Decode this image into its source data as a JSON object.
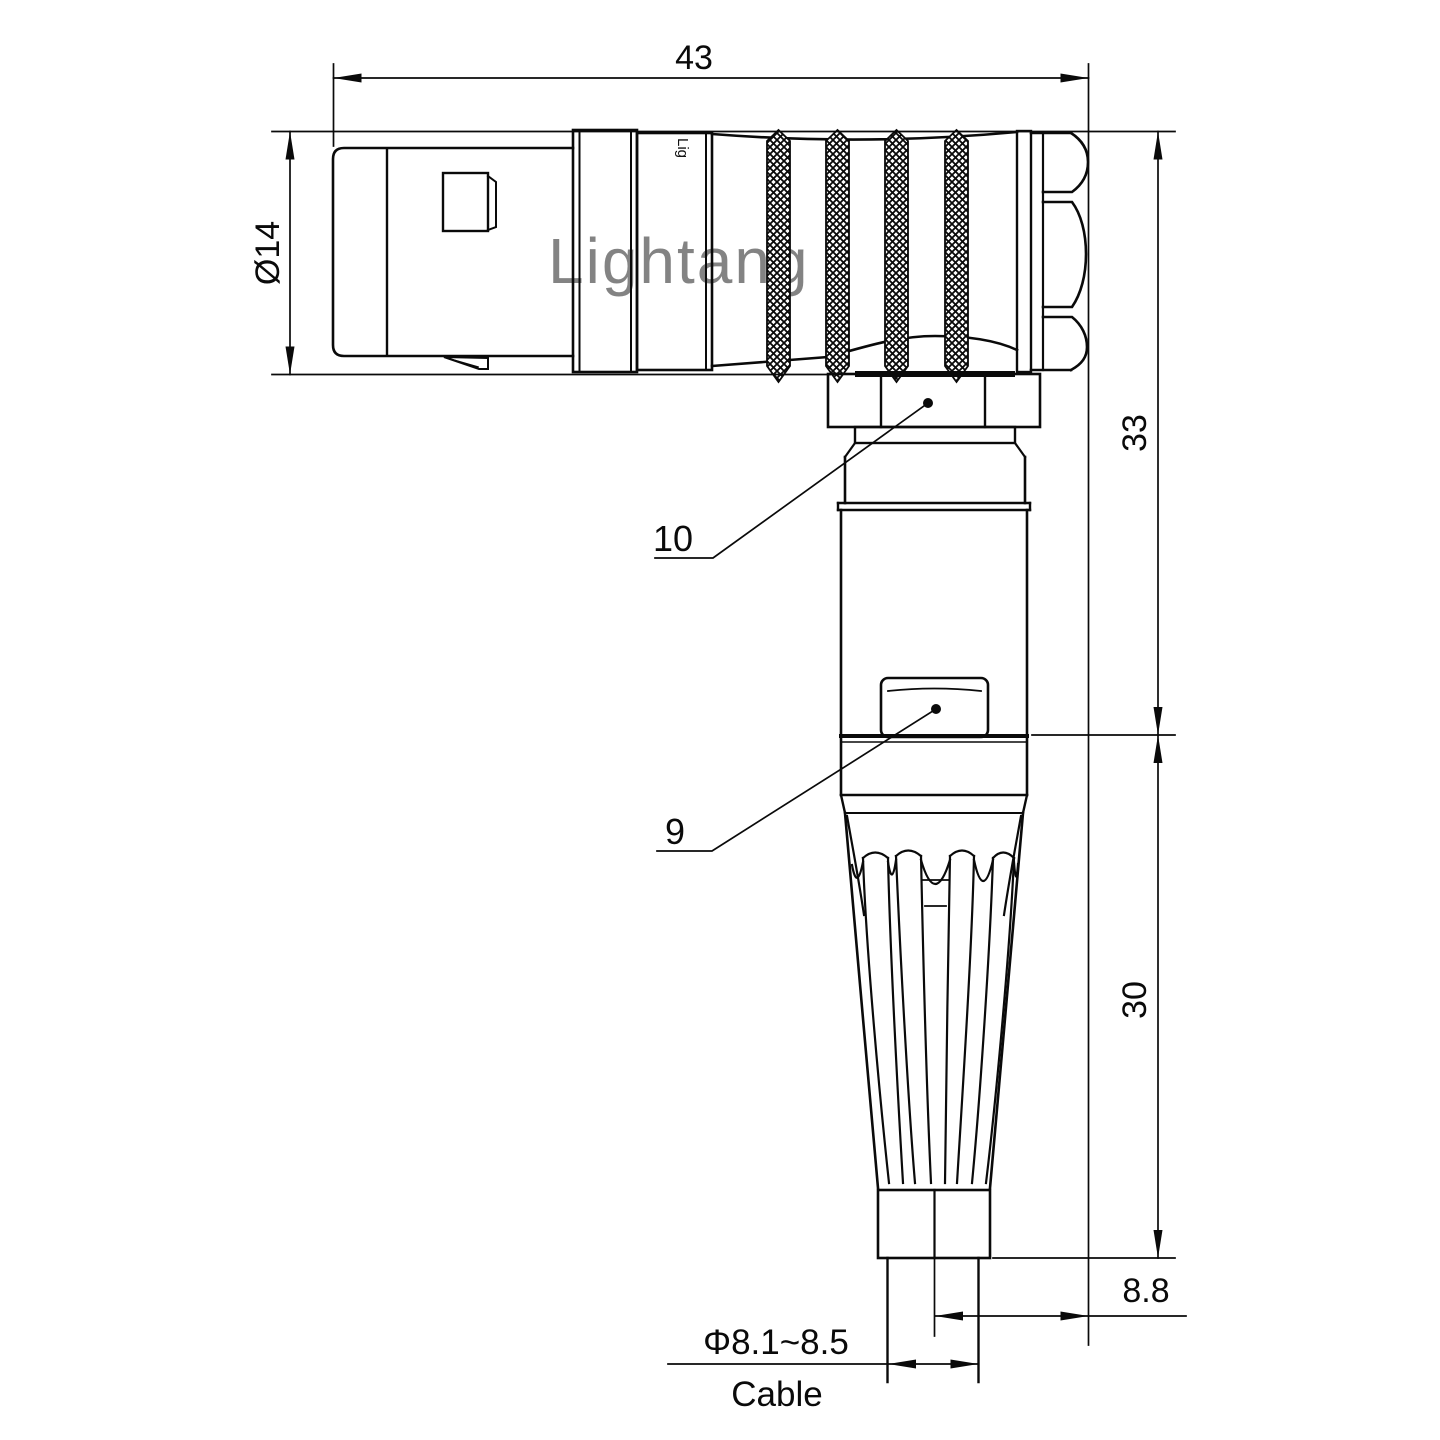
{
  "drawing": {
    "type": "right-angle connector plug, dimensioned engineering drawing",
    "line_color": "#0a0a0a",
    "background": "#ffffff"
  },
  "labels": {
    "len43": "43",
    "dia14": "Ø14",
    "h33": "33",
    "h30": "30",
    "off88": "8.8",
    "cable_dia": "Φ8.1~8.5",
    "cable": "Cable",
    "p10": "10",
    "p9": "9"
  },
  "watermark": {
    "text": "Lightang",
    "print": "Lig",
    "color": "#e59494"
  }
}
